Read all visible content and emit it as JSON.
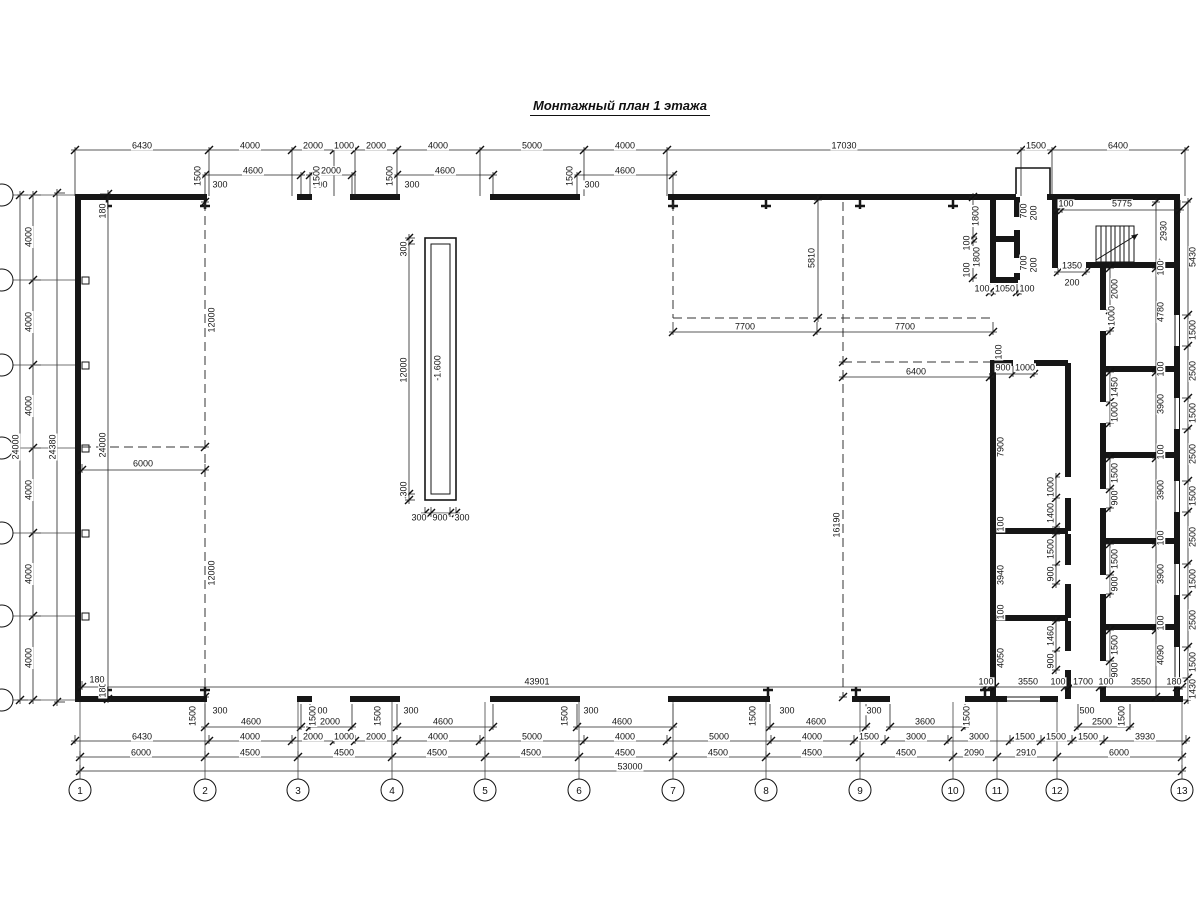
{
  "title": "Монтажный план 1 этажа",
  "pit": {
    "mark": "-1.600"
  },
  "axes": {
    "bottom": [
      {
        "n": "1",
        "x": 80
      },
      {
        "n": "2",
        "x": 205
      },
      {
        "n": "3",
        "x": 298
      },
      {
        "n": "4",
        "x": 392
      },
      {
        "n": "5",
        "x": 485
      },
      {
        "n": "6",
        "x": 579
      },
      {
        "n": "7",
        "x": 673
      },
      {
        "n": "8",
        "x": 766
      },
      {
        "n": "9",
        "x": 860
      },
      {
        "n": "10",
        "x": 953
      },
      {
        "n": "11",
        "x": 997
      },
      {
        "n": "12",
        "x": 1057
      },
      {
        "n": "13",
        "x": 1182
      }
    ],
    "left_y": [
      195,
      280,
      365,
      448,
      533,
      616,
      700
    ]
  },
  "dim_rows": [
    {
      "d": "h",
      "p": 150,
      "s": [
        75,
        209,
        292,
        334,
        355,
        397,
        480,
        584,
        667,
        1021,
        1052,
        1185
      ],
      "e1": 3,
      "e2": 46
    },
    {
      "d": "h",
      "p": 175,
      "s": [
        205,
        301
      ],
      "e1": 3,
      "e2": 19
    },
    {
      "d": "h",
      "p": 175,
      "s": [
        310,
        352
      ],
      "e1": 3,
      "e2": 19
    },
    {
      "d": "h",
      "p": 175,
      "s": [
        397,
        493
      ],
      "e1": 3,
      "e2": 19
    },
    {
      "d": "h",
      "p": 175,
      "s": [
        577,
        673
      ],
      "e1": 3,
      "e2": 19
    },
    {
      "d": "h",
      "p": 210,
      "s": [
        1058,
        1062,
        1180
      ],
      "e1": 10,
      "e2": 3
    },
    {
      "d": "v",
      "p": 20,
      "s": [
        195,
        700
      ],
      "e1": 3,
      "e2": 8
    },
    {
      "d": "v",
      "p": 33,
      "s": [
        195,
        280,
        365,
        448,
        533,
        616,
        700
      ],
      "e1": 3,
      "e2": 8
    },
    {
      "d": "v",
      "p": 57,
      "s": [
        193,
        702
      ],
      "e1": 3,
      "e2": 8
    },
    {
      "d": "v",
      "p": 108,
      "s": [
        194,
        699
      ],
      "e1": 8,
      "e2": 3
    },
    {
      "d": "h",
      "p": 470,
      "s": [
        82,
        205
      ],
      "e1": 6,
      "e2": 3
    },
    {
      "d": "h",
      "p": 332,
      "s": [
        673,
        817,
        993
      ],
      "e1": 10,
      "e2": 3
    },
    {
      "d": "v",
      "p": 818,
      "s": [
        200,
        318
      ],
      "e1": 4,
      "e2": 4
    },
    {
      "d": "h",
      "p": 377,
      "s": [
        843,
        990
      ],
      "e1": 4,
      "e2": 3
    },
    {
      "d": "h",
      "p": 374,
      "s": [
        993,
        1013,
        1034
      ],
      "e1": 8,
      "e2": 3
    },
    {
      "d": "v",
      "p": 409,
      "s": [
        238,
        244,
        494,
        500
      ],
      "e1": 4,
      "e2": 6
    },
    {
      "d": "h",
      "p": 513,
      "s": [
        425,
        431,
        450,
        456
      ],
      "e1": 6,
      "e2": 4
    },
    {
      "d": "v",
      "p": 1056,
      "s": [
        477,
        498,
        527
      ],
      "e1": 4,
      "e2": 4
    },
    {
      "d": "v",
      "p": 1056,
      "s": [
        534,
        565,
        584
      ],
      "e1": 4,
      "e2": 4
    },
    {
      "d": "v",
      "p": 1056,
      "s": [
        621,
        651,
        670
      ],
      "e1": 4,
      "e2": 4
    },
    {
      "d": "v",
      "p": 1110,
      "s": [
        268,
        310,
        331
      ],
      "e1": 4,
      "e2": 4
    },
    {
      "d": "v",
      "p": 1110,
      "s": [
        372,
        402,
        423
      ],
      "e1": 4,
      "e2": 4
    },
    {
      "d": "v",
      "p": 1110,
      "s": [
        458,
        489,
        508
      ],
      "e1": 4,
      "e2": 4
    },
    {
      "d": "v",
      "p": 1110,
      "s": [
        544,
        575,
        594
      ],
      "e1": 4,
      "e2": 4
    },
    {
      "d": "v",
      "p": 1110,
      "s": [
        630,
        661,
        680
      ],
      "e1": 4,
      "e2": 4
    },
    {
      "d": "v",
      "p": 1156,
      "s": [
        202,
        263,
        268,
        367,
        372,
        453,
        458,
        539,
        544,
        625,
        630,
        697
      ],
      "e1": 4,
      "e2": 4
    },
    {
      "d": "v",
      "p": 973,
      "s": [
        197,
        237,
        242,
        278
      ],
      "e1": 4,
      "e2": 4
    },
    {
      "d": "h",
      "p": 292,
      "s": [
        990,
        995,
        1017,
        1021
      ],
      "e1": 8,
      "e2": 3
    },
    {
      "d": "h",
      "p": 272,
      "s": [
        1058,
        1086
      ],
      "e1": 4,
      "e2": 3
    },
    {
      "d": "v",
      "p": 205,
      "s": [
        202,
        447,
        697
      ],
      "e1": 4,
      "e2": 4,
      "nb": 1
    },
    {
      "d": "v",
      "p": 843,
      "s": [
        362,
        697
      ],
      "e1": 4,
      "e2": 4,
      "nb": 1
    },
    {
      "d": "h",
      "p": 687,
      "s": [
        82,
        995
      ],
      "e1": 6,
      "e2": 3
    },
    {
      "d": "h",
      "p": 687,
      "s": [
        985,
        990,
        1065,
        1070,
        1100,
        1105,
        1177,
        1182
      ],
      "e1": 6,
      "e2": 3
    },
    {
      "d": "h",
      "p": 727,
      "s": [
        205,
        301
      ],
      "e1": 23,
      "e2": 3
    },
    {
      "d": "h",
      "p": 727,
      "s": [
        310,
        352
      ],
      "e1": 23,
      "e2": 3
    },
    {
      "d": "h",
      "p": 727,
      "s": [
        397,
        493
      ],
      "e1": 23,
      "e2": 3
    },
    {
      "d": "h",
      "p": 727,
      "s": [
        577,
        673
      ],
      "e1": 23,
      "e2": 3
    },
    {
      "d": "h",
      "p": 727,
      "s": [
        770,
        866
      ],
      "e1": 23,
      "e2": 3
    },
    {
      "d": "h",
      "p": 727,
      "s": [
        890,
        965
      ],
      "e1": 23,
      "e2": 3
    },
    {
      "d": "h",
      "p": 727,
      "s": [
        1078,
        1130
      ],
      "e1": 23,
      "e2": 3
    },
    {
      "d": "h",
      "p": 741,
      "s": [
        75,
        209,
        292,
        334,
        355,
        397,
        480,
        584,
        667,
        771,
        854,
        885,
        948,
        1010,
        1041,
        1072,
        1104,
        1186
      ],
      "e1": 6,
      "e2": 3
    },
    {
      "d": "h",
      "p": 757,
      "s": [
        80,
        205,
        298,
        392,
        485,
        579,
        673,
        766,
        860,
        953,
        997,
        1057,
        1182
      ],
      "e1": 6,
      "e2": 3
    },
    {
      "d": "h",
      "p": 771,
      "s": [
        80,
        1182
      ],
      "e1": 6,
      "e2": 3
    },
    {
      "d": "v",
      "p": 1188,
      "s": [
        202,
        315,
        346,
        398,
        429,
        481,
        512,
        564,
        595,
        647,
        678,
        700
      ],
      "e1": 6,
      "e2": 3
    }
  ],
  "labels": [
    {
      "t": "6430",
      "x": 142,
      "y": 146
    },
    {
      "t": "4000",
      "x": 250,
      "y": 146
    },
    {
      "t": "2000",
      "x": 313,
      "y": 146
    },
    {
      "t": "1000",
      "x": 344,
      "y": 146
    },
    {
      "t": "2000",
      "x": 376,
      "y": 146
    },
    {
      "t": "4000",
      "x": 438,
      "y": 146
    },
    {
      "t": "5000",
      "x": 532,
      "y": 146
    },
    {
      "t": "4000",
      "x": 625,
      "y": 146
    },
    {
      "t": "17030",
      "x": 844,
      "y": 146
    },
    {
      "t": "1500",
      "x": 1036,
      "y": 146
    },
    {
      "t": "6400",
      "x": 1118,
      "y": 146
    },
    {
      "t": "4600",
      "x": 253,
      "y": 171
    },
    {
      "t": "2000",
      "x": 331,
      "y": 171
    },
    {
      "t": "4600",
      "x": 445,
      "y": 171
    },
    {
      "t": "4600",
      "x": 625,
      "y": 171
    },
    {
      "t": "300",
      "x": 220,
      "y": 185
    },
    {
      "t": "500",
      "x": 320,
      "y": 185
    },
    {
      "t": "300",
      "x": 412,
      "y": 185
    },
    {
      "t": "300",
      "x": 592,
      "y": 185
    },
    {
      "t": "1500",
      "x": 198,
      "y": 176,
      "r": 1
    },
    {
      "t": "1500",
      "x": 317,
      "y": 176,
      "r": 1
    },
    {
      "t": "1500",
      "x": 390,
      "y": 176,
      "r": 1
    },
    {
      "t": "1500",
      "x": 570,
      "y": 176,
      "r": 1
    },
    {
      "t": "100",
      "x": 1066,
      "y": 204
    },
    {
      "t": "5775",
      "x": 1122,
      "y": 204
    },
    {
      "t": "24000",
      "x": 16,
      "y": 447,
      "r": 1
    },
    {
      "t": "4000",
      "x": 29,
      "y": 237,
      "r": 1
    },
    {
      "t": "4000",
      "x": 29,
      "y": 322,
      "r": 1
    },
    {
      "t": "4000",
      "x": 29,
      "y": 406,
      "r": 1
    },
    {
      "t": "4000",
      "x": 29,
      "y": 490,
      "r": 1
    },
    {
      "t": "4000",
      "x": 29,
      "y": 574,
      "r": 1
    },
    {
      "t": "4000",
      "x": 29,
      "y": 658,
      "r": 1
    },
    {
      "t": "24380",
      "x": 53,
      "y": 447,
      "r": 1
    },
    {
      "t": "180",
      "x": 103,
      "y": 211,
      "r": 1
    },
    {
      "t": "24000",
      "x": 103,
      "y": 445,
      "r": 1
    },
    {
      "t": "180",
      "x": 103,
      "y": 690,
      "r": 1
    },
    {
      "t": "180",
      "x": 97,
      "y": 680
    },
    {
      "t": "6000",
      "x": 143,
      "y": 464
    },
    {
      "t": "12000",
      "x": 212,
      "y": 320,
      "r": 1
    },
    {
      "t": "12000",
      "x": 212,
      "y": 573,
      "r": 1
    },
    {
      "t": "300",
      "x": 404,
      "y": 249,
      "r": 1
    },
    {
      "t": "12000",
      "x": 404,
      "y": 370,
      "r": 1
    },
    {
      "t": "300",
      "x": 404,
      "y": 489,
      "r": 1
    },
    {
      "t": "300",
      "x": 419,
      "y": 518
    },
    {
      "t": "900",
      "x": 440,
      "y": 518
    },
    {
      "t": "300",
      "x": 462,
      "y": 518
    },
    {
      "t": "-1.600",
      "x": 438,
      "y": 368,
      "r": 1
    },
    {
      "t": "5810",
      "x": 812,
      "y": 258,
      "r": 1
    },
    {
      "t": "7700",
      "x": 745,
      "y": 327
    },
    {
      "t": "7700",
      "x": 905,
      "y": 327
    },
    {
      "t": "6400",
      "x": 916,
      "y": 372
    },
    {
      "t": "16190",
      "x": 837,
      "y": 525,
      "r": 1
    },
    {
      "t": "100",
      "x": 999,
      "y": 352,
      "r": 1
    },
    {
      "t": "900",
      "x": 1003,
      "y": 368
    },
    {
      "t": "1000",
      "x": 1025,
      "y": 368
    },
    {
      "t": "7900",
      "x": 1001,
      "y": 447,
      "r": 1
    },
    {
      "t": "100",
      "x": 1001,
      "y": 524,
      "r": 1
    },
    {
      "t": "3940",
      "x": 1001,
      "y": 575,
      "r": 1
    },
    {
      "t": "100",
      "x": 1001,
      "y": 612,
      "r": 1
    },
    {
      "t": "4050",
      "x": 1001,
      "y": 658,
      "r": 1
    },
    {
      "t": "1000",
      "x": 1051,
      "y": 487,
      "r": 1
    },
    {
      "t": "1400",
      "x": 1051,
      "y": 513,
      "r": 1
    },
    {
      "t": "1500",
      "x": 1051,
      "y": 549,
      "r": 1
    },
    {
      "t": "900",
      "x": 1051,
      "y": 574,
      "r": 1
    },
    {
      "t": "1460",
      "x": 1051,
      "y": 636,
      "r": 1
    },
    {
      "t": "900",
      "x": 1051,
      "y": 661,
      "r": 1
    },
    {
      "t": "2000",
      "x": 1115,
      "y": 289,
      "r": 1
    },
    {
      "t": "1000",
      "x": 1112,
      "y": 316,
      "r": 1
    },
    {
      "t": "1450",
      "x": 1115,
      "y": 387,
      "r": 1
    },
    {
      "t": "1000",
      "x": 1115,
      "y": 412,
      "r": 1
    },
    {
      "t": "1500",
      "x": 1115,
      "y": 473,
      "r": 1
    },
    {
      "t": "900",
      "x": 1115,
      "y": 498,
      "r": 1
    },
    {
      "t": "1500",
      "x": 1115,
      "y": 559,
      "r": 1
    },
    {
      "t": "900",
      "x": 1115,
      "y": 584,
      "r": 1
    },
    {
      "t": "1500",
      "x": 1115,
      "y": 645,
      "r": 1
    },
    {
      "t": "900",
      "x": 1115,
      "y": 670,
      "r": 1
    },
    {
      "t": "2930",
      "x": 1164,
      "y": 231,
      "r": 1
    },
    {
      "t": "100",
      "x": 1161,
      "y": 268,
      "r": 1
    },
    {
      "t": "4780",
      "x": 1161,
      "y": 312,
      "r": 1
    },
    {
      "t": "100",
      "x": 1161,
      "y": 369,
      "r": 1
    },
    {
      "t": "3900",
      "x": 1161,
      "y": 404,
      "r": 1
    },
    {
      "t": "100",
      "x": 1161,
      "y": 452,
      "r": 1
    },
    {
      "t": "3900",
      "x": 1161,
      "y": 490,
      "r": 1
    },
    {
      "t": "100",
      "x": 1161,
      "y": 538,
      "r": 1
    },
    {
      "t": "3900",
      "x": 1161,
      "y": 574,
      "r": 1
    },
    {
      "t": "100",
      "x": 1161,
      "y": 623,
      "r": 1
    },
    {
      "t": "4090",
      "x": 1161,
      "y": 655,
      "r": 1
    },
    {
      "t": "1800",
      "x": 976,
      "y": 216,
      "r": 1
    },
    {
      "t": "100",
      "x": 967,
      "y": 243,
      "r": 1
    },
    {
      "t": "1800",
      "x": 977,
      "y": 257,
      "r": 1
    },
    {
      "t": "100",
      "x": 967,
      "y": 270,
      "r": 1
    },
    {
      "t": "700",
      "x": 1024,
      "y": 211,
      "r": 1
    },
    {
      "t": "200",
      "x": 1034,
      "y": 213,
      "r": 1
    },
    {
      "t": "700",
      "x": 1024,
      "y": 263,
      "r": 1
    },
    {
      "t": "200",
      "x": 1034,
      "y": 265,
      "r": 1
    },
    {
      "t": "100",
      "x": 982,
      "y": 289
    },
    {
      "t": "1050",
      "x": 1005,
      "y": 289
    },
    {
      "t": "100",
      "x": 1027,
      "y": 289
    },
    {
      "t": "1350",
      "x": 1072,
      "y": 266
    },
    {
      "t": "200",
      "x": 1072,
      "y": 283
    },
    {
      "t": "100",
      "x": 986,
      "y": 682
    },
    {
      "t": "3550",
      "x": 1028,
      "y": 682
    },
    {
      "t": "100",
      "x": 1058,
      "y": 682
    },
    {
      "t": "1700",
      "x": 1083,
      "y": 682
    },
    {
      "t": "100",
      "x": 1106,
      "y": 682
    },
    {
      "t": "3550",
      "x": 1141,
      "y": 682
    },
    {
      "t": "180",
      "x": 1174,
      "y": 682
    },
    {
      "t": "43901",
      "x": 537,
      "y": 682
    },
    {
      "t": "4600",
      "x": 251,
      "y": 722
    },
    {
      "t": "2000",
      "x": 330,
      "y": 722
    },
    {
      "t": "4600",
      "x": 443,
      "y": 722
    },
    {
      "t": "4600",
      "x": 622,
      "y": 722
    },
    {
      "t": "4600",
      "x": 816,
      "y": 722
    },
    {
      "t": "3600",
      "x": 925,
      "y": 722
    },
    {
      "t": "2500",
      "x": 1102,
      "y": 722
    },
    {
      "t": "300",
      "x": 220,
      "y": 711
    },
    {
      "t": "500",
      "x": 320,
      "y": 711
    },
    {
      "t": "300",
      "x": 411,
      "y": 711
    },
    {
      "t": "300",
      "x": 591,
      "y": 711
    },
    {
      "t": "300",
      "x": 787,
      "y": 711
    },
    {
      "t": "300",
      "x": 874,
      "y": 711
    },
    {
      "t": "500",
      "x": 1087,
      "y": 711
    },
    {
      "t": "1500",
      "x": 193,
      "y": 716,
      "r": 1
    },
    {
      "t": "1500",
      "x": 313,
      "y": 716,
      "r": 1
    },
    {
      "t": "1500",
      "x": 378,
      "y": 716,
      "r": 1
    },
    {
      "t": "1500",
      "x": 565,
      "y": 716,
      "r": 1
    },
    {
      "t": "1500",
      "x": 753,
      "y": 716,
      "r": 1
    },
    {
      "t": "1500",
      "x": 967,
      "y": 716,
      "r": 1
    },
    {
      "t": "1500",
      "x": 1122,
      "y": 716,
      "r": 1
    },
    {
      "t": "6430",
      "x": 142,
      "y": 737
    },
    {
      "t": "4000",
      "x": 250,
      "y": 737
    },
    {
      "t": "2000",
      "x": 313,
      "y": 737
    },
    {
      "t": "1000",
      "x": 344,
      "y": 737
    },
    {
      "t": "2000",
      "x": 376,
      "y": 737
    },
    {
      "t": "4000",
      "x": 438,
      "y": 737
    },
    {
      "t": "5000",
      "x": 532,
      "y": 737
    },
    {
      "t": "4000",
      "x": 625,
      "y": 737
    },
    {
      "t": "5000",
      "x": 719,
      "y": 737
    },
    {
      "t": "4000",
      "x": 812,
      "y": 737
    },
    {
      "t": "1500",
      "x": 869,
      "y": 737
    },
    {
      "t": "3000",
      "x": 916,
      "y": 737
    },
    {
      "t": "3000",
      "x": 979,
      "y": 737
    },
    {
      "t": "1500",
      "x": 1025,
      "y": 737
    },
    {
      "t": "1500",
      "x": 1056,
      "y": 737
    },
    {
      "t": "1500",
      "x": 1088,
      "y": 737
    },
    {
      "t": "3930",
      "x": 1145,
      "y": 737
    },
    {
      "t": "6000",
      "x": 141,
      "y": 753
    },
    {
      "t": "4500",
      "x": 250,
      "y": 753
    },
    {
      "t": "4500",
      "x": 344,
      "y": 753
    },
    {
      "t": "4500",
      "x": 437,
      "y": 753
    },
    {
      "t": "4500",
      "x": 531,
      "y": 753
    },
    {
      "t": "4500",
      "x": 625,
      "y": 753
    },
    {
      "t": "4500",
      "x": 718,
      "y": 753
    },
    {
      "t": "4500",
      "x": 812,
      "y": 753
    },
    {
      "t": "4500",
      "x": 906,
      "y": 753
    },
    {
      "t": "2090",
      "x": 974,
      "y": 753
    },
    {
      "t": "2910",
      "x": 1026,
      "y": 753
    },
    {
      "t": "6000",
      "x": 1119,
      "y": 753
    },
    {
      "t": "53000",
      "x": 630,
      "y": 767
    },
    {
      "t": "5430",
      "x": 1193,
      "y": 257,
      "r": 1
    },
    {
      "t": "1500",
      "x": 1193,
      "y": 330,
      "r": 1
    },
    {
      "t": "2500",
      "x": 1193,
      "y": 371,
      "r": 1
    },
    {
      "t": "1500",
      "x": 1193,
      "y": 413,
      "r": 1
    },
    {
      "t": "2500",
      "x": 1193,
      "y": 454,
      "r": 1
    },
    {
      "t": "1500",
      "x": 1193,
      "y": 496,
      "r": 1
    },
    {
      "t": "2500",
      "x": 1193,
      "y": 537,
      "r": 1
    },
    {
      "t": "1500",
      "x": 1193,
      "y": 579,
      "r": 1
    },
    {
      "t": "2500",
      "x": 1193,
      "y": 620,
      "r": 1
    },
    {
      "t": "1500",
      "x": 1193,
      "y": 662,
      "r": 1
    },
    {
      "t": "1430",
      "x": 1193,
      "y": 689,
      "r": 1
    }
  ]
}
